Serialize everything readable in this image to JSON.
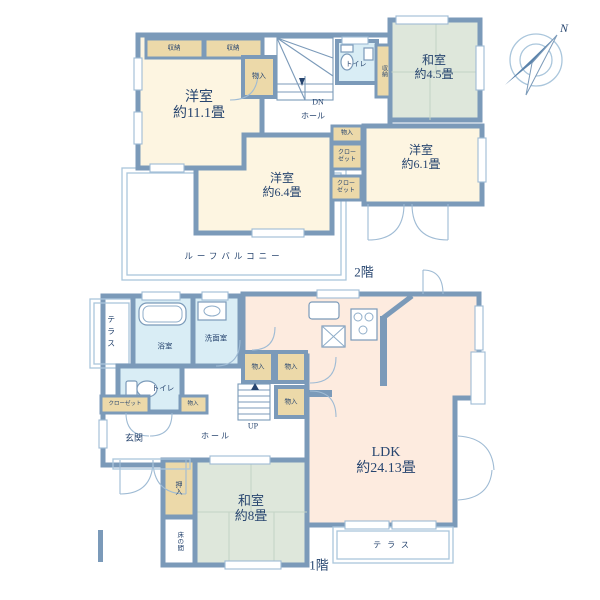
{
  "compass": {
    "north": "N"
  },
  "colors": {
    "wall": "#7b9ab9",
    "western_room": "#fdf5e1",
    "closet": "#ecd9a9",
    "tatami_room": "#dee7db",
    "ldk": "#fdebdf",
    "wet_area": "#d9edf5",
    "label_text": "#27456f",
    "outline": "#aac6dc"
  },
  "floor2": {
    "label": "2階",
    "rooms": {
      "yoshitsu111": {
        "name": "洋室",
        "size": "約11.1畳"
      },
      "yoshitsu64": {
        "name": "洋室",
        "size": "約6.4畳"
      },
      "yoshitsu61": {
        "name": "洋室",
        "size": "約6.1畳"
      },
      "washitsu45": {
        "name": "和室",
        "size": "約4.5畳"
      },
      "toilet": "トイレ",
      "hall": "ホール",
      "dn": "DN",
      "storage1": "収納",
      "storage2": "収納",
      "storage_side": "収納",
      "monoiri_top": "物入",
      "monoiri_mid": "物入",
      "closet_upper_l1": "クロー",
      "closet_upper_l2": "ゼット",
      "closet_lower_l1": "クロー",
      "closet_lower_l2": "ゼット",
      "roof_balcony": "ルーフバルコニー"
    }
  },
  "floor1": {
    "label": "1階",
    "rooms": {
      "ldk": {
        "name": "LDK",
        "size": "約24.13畳"
      },
      "washitsu8": {
        "name": "和室",
        "size": "約8畳"
      },
      "bathroom": "浴室",
      "washroom": "洗面室",
      "toilet": "トイレ",
      "closet": "クローゼット",
      "monoiri_toilet": "物入",
      "monoiri_a": "物入",
      "monoiri_b": "物入",
      "monoiri_c": "物入",
      "genkan": "玄関",
      "hall": "ホール",
      "up": "UP",
      "oshiire": "押入",
      "tokonoma": "床の間",
      "terrace_left": "テラス",
      "terrace_south": "テラス"
    }
  }
}
